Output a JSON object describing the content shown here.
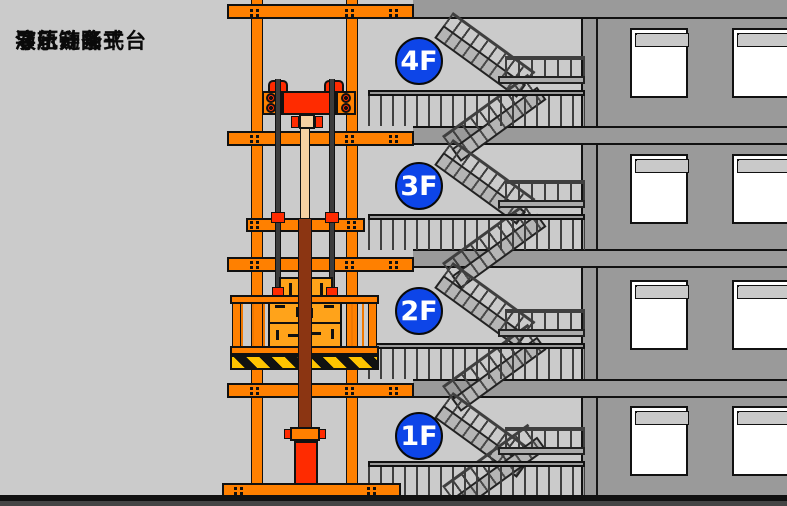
{
  "header": {
    "title_lines": [
      "导轨链条式",
      "液压升降平台",
      "演示动画"
    ]
  },
  "floors": [
    {
      "label": "4F"
    },
    {
      "label": "3F"
    },
    {
      "label": "2F"
    },
    {
      "label": "1F"
    }
  ],
  "colors": {
    "background_gray": "#CBCBCB",
    "wall_gray": "#9A9A9A",
    "mast_orange": "#FF8000",
    "cylinder_red": "#FF2B00",
    "cargo_orange": "#FFA31A",
    "piston_tan": "#F5D0A2",
    "rod_brown": "#8B3512",
    "chain_gray": "#3C3C3C",
    "hazard_yellow": "#FFC400",
    "badge_blue": "#0D45E8",
    "badge_text": "#FFFFFF"
  }
}
